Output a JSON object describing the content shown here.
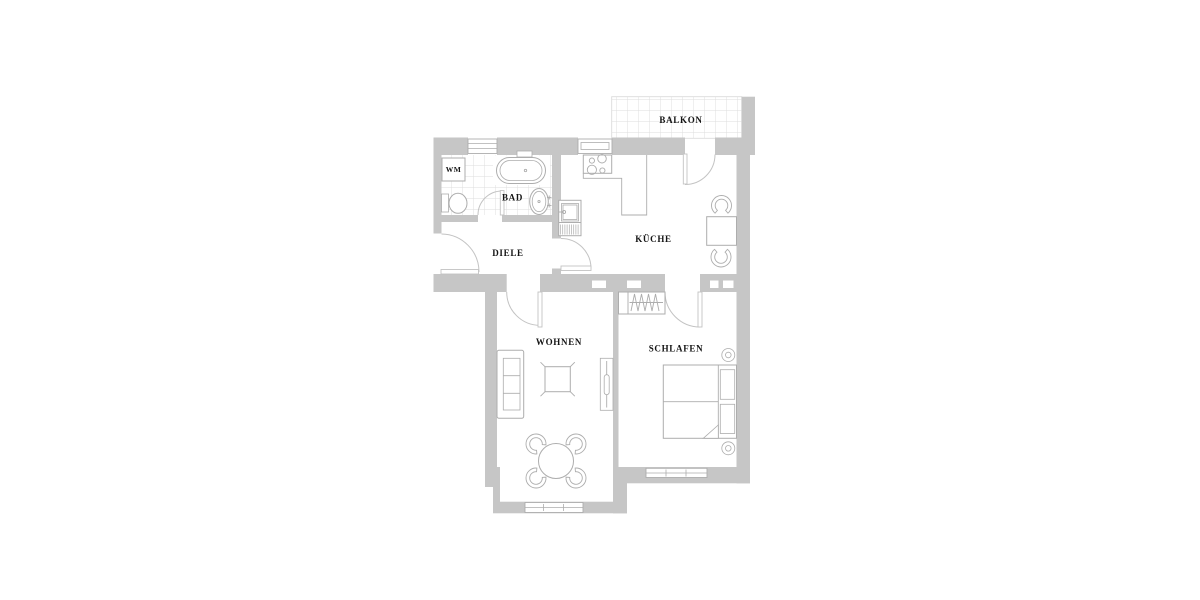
{
  "plan": {
    "type": "apartment-floor-plan",
    "rooms": {
      "balkon": "BALKON",
      "wm": "WM",
      "bad": "BAD",
      "diele": "DIELE",
      "kueche": "KÜCHE",
      "wohnen": "WOHNEN",
      "schlafen": "SCHLAFEN"
    }
  },
  "colors": {
    "wall": "#c6c6c6",
    "furniture_line": "#adadad",
    "tile_line": "#dcdcdc",
    "door_line": "#c3c3c3",
    "label": "#141414",
    "background": "#ffffff"
  }
}
